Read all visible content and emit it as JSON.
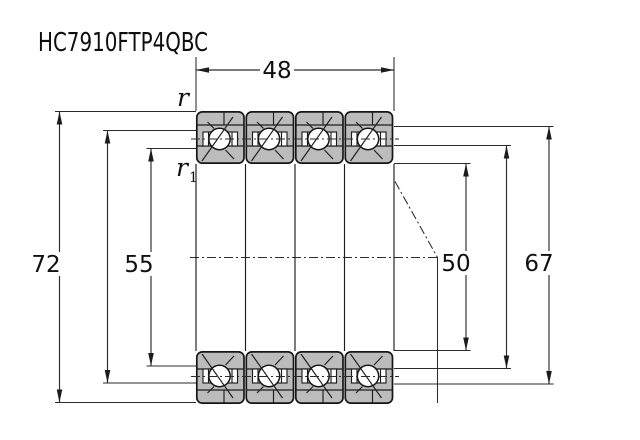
{
  "title": "HC7910FTP4QBC",
  "drawing": {
    "type": "bearing-cross-section",
    "bearing_units": 4,
    "dims": {
      "width": "48",
      "outer_diameter": "72",
      "left_inner": "55",
      "bore": "50",
      "right_inner": "67",
      "chamfer": "r",
      "chamfer_inner_base": "r",
      "chamfer_inner_sub": "1"
    },
    "colors": {
      "ring_fill": "#bcbcbc",
      "line": "#1c1c1c",
      "background": "#ffffff"
    }
  }
}
